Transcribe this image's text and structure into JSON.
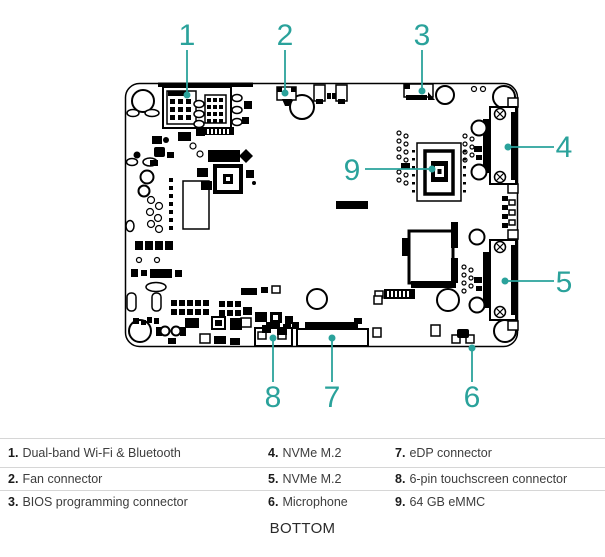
{
  "accent_color": "#2aa29b",
  "divider_color": "#d6d6d6",
  "view_label": "BOTTOM",
  "callouts": {
    "c1": "1",
    "c2": "2",
    "c3": "3",
    "c4": "4",
    "c5": "5",
    "c6": "6",
    "c7": "7",
    "c8": "8",
    "c9": "9"
  },
  "legend": {
    "rows": [
      [
        {
          "num": "1.",
          "label": "Dual-band Wi-Fi & Bluetooth"
        },
        {
          "num": "4.",
          "label": "NVMe M.2"
        },
        {
          "num": "7.",
          "label": "eDP connector"
        }
      ],
      [
        {
          "num": "2.",
          "label": "Fan connector"
        },
        {
          "num": "5.",
          "label": "NVMe M.2"
        },
        {
          "num": "8.",
          "label": "6-pin touchscreen connector"
        }
      ],
      [
        {
          "num": "3.",
          "label": "BIOS programming connector"
        },
        {
          "num": "6.",
          "label": "Microphone"
        },
        {
          "num": "9.",
          "label": "64 GB eMMC"
        }
      ]
    ]
  }
}
